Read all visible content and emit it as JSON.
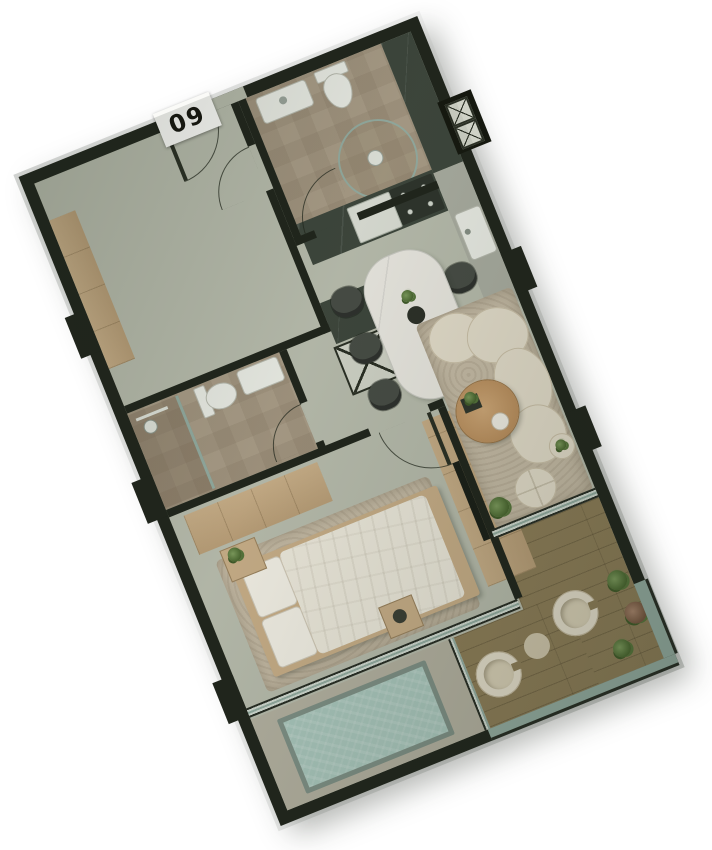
{
  "unit_badge": {
    "label": "09"
  },
  "plan": {
    "rotation_deg": -22,
    "rooms": [
      "entry-foyer",
      "bathroom-1",
      "kitchen",
      "flex-room",
      "hallway",
      "bathroom-2",
      "utility-closet",
      "dining-area",
      "bedroom",
      "living-area",
      "terrace",
      "pool-area"
    ],
    "dining_chairs": 6,
    "terrace_lounge_chairs": 2,
    "terrace_plants": 3,
    "elevator_marker_boxes": 2
  },
  "colors": {
    "wall": "#20251c",
    "floor": "#b7bbac",
    "bathFloor": "#a89b86",
    "wood": "#c7ad87",
    "deck": "#8c7c57",
    "water": "#a9c6bc",
    "poolDeck": "#b3b0a0",
    "rug": "#c6bba6",
    "cream": "#e4ddcb",
    "creamDark": "#cbc0a8",
    "marbleTable": "#e9e7e0",
    "chair": "#474c45",
    "counter": "#3d463c",
    "counterLight": "#a9aca0",
    "white": "#e9ebe4",
    "glass": "#93aba0",
    "badgeBg": "#fafaf7",
    "badgeText": "#15150f"
  }
}
